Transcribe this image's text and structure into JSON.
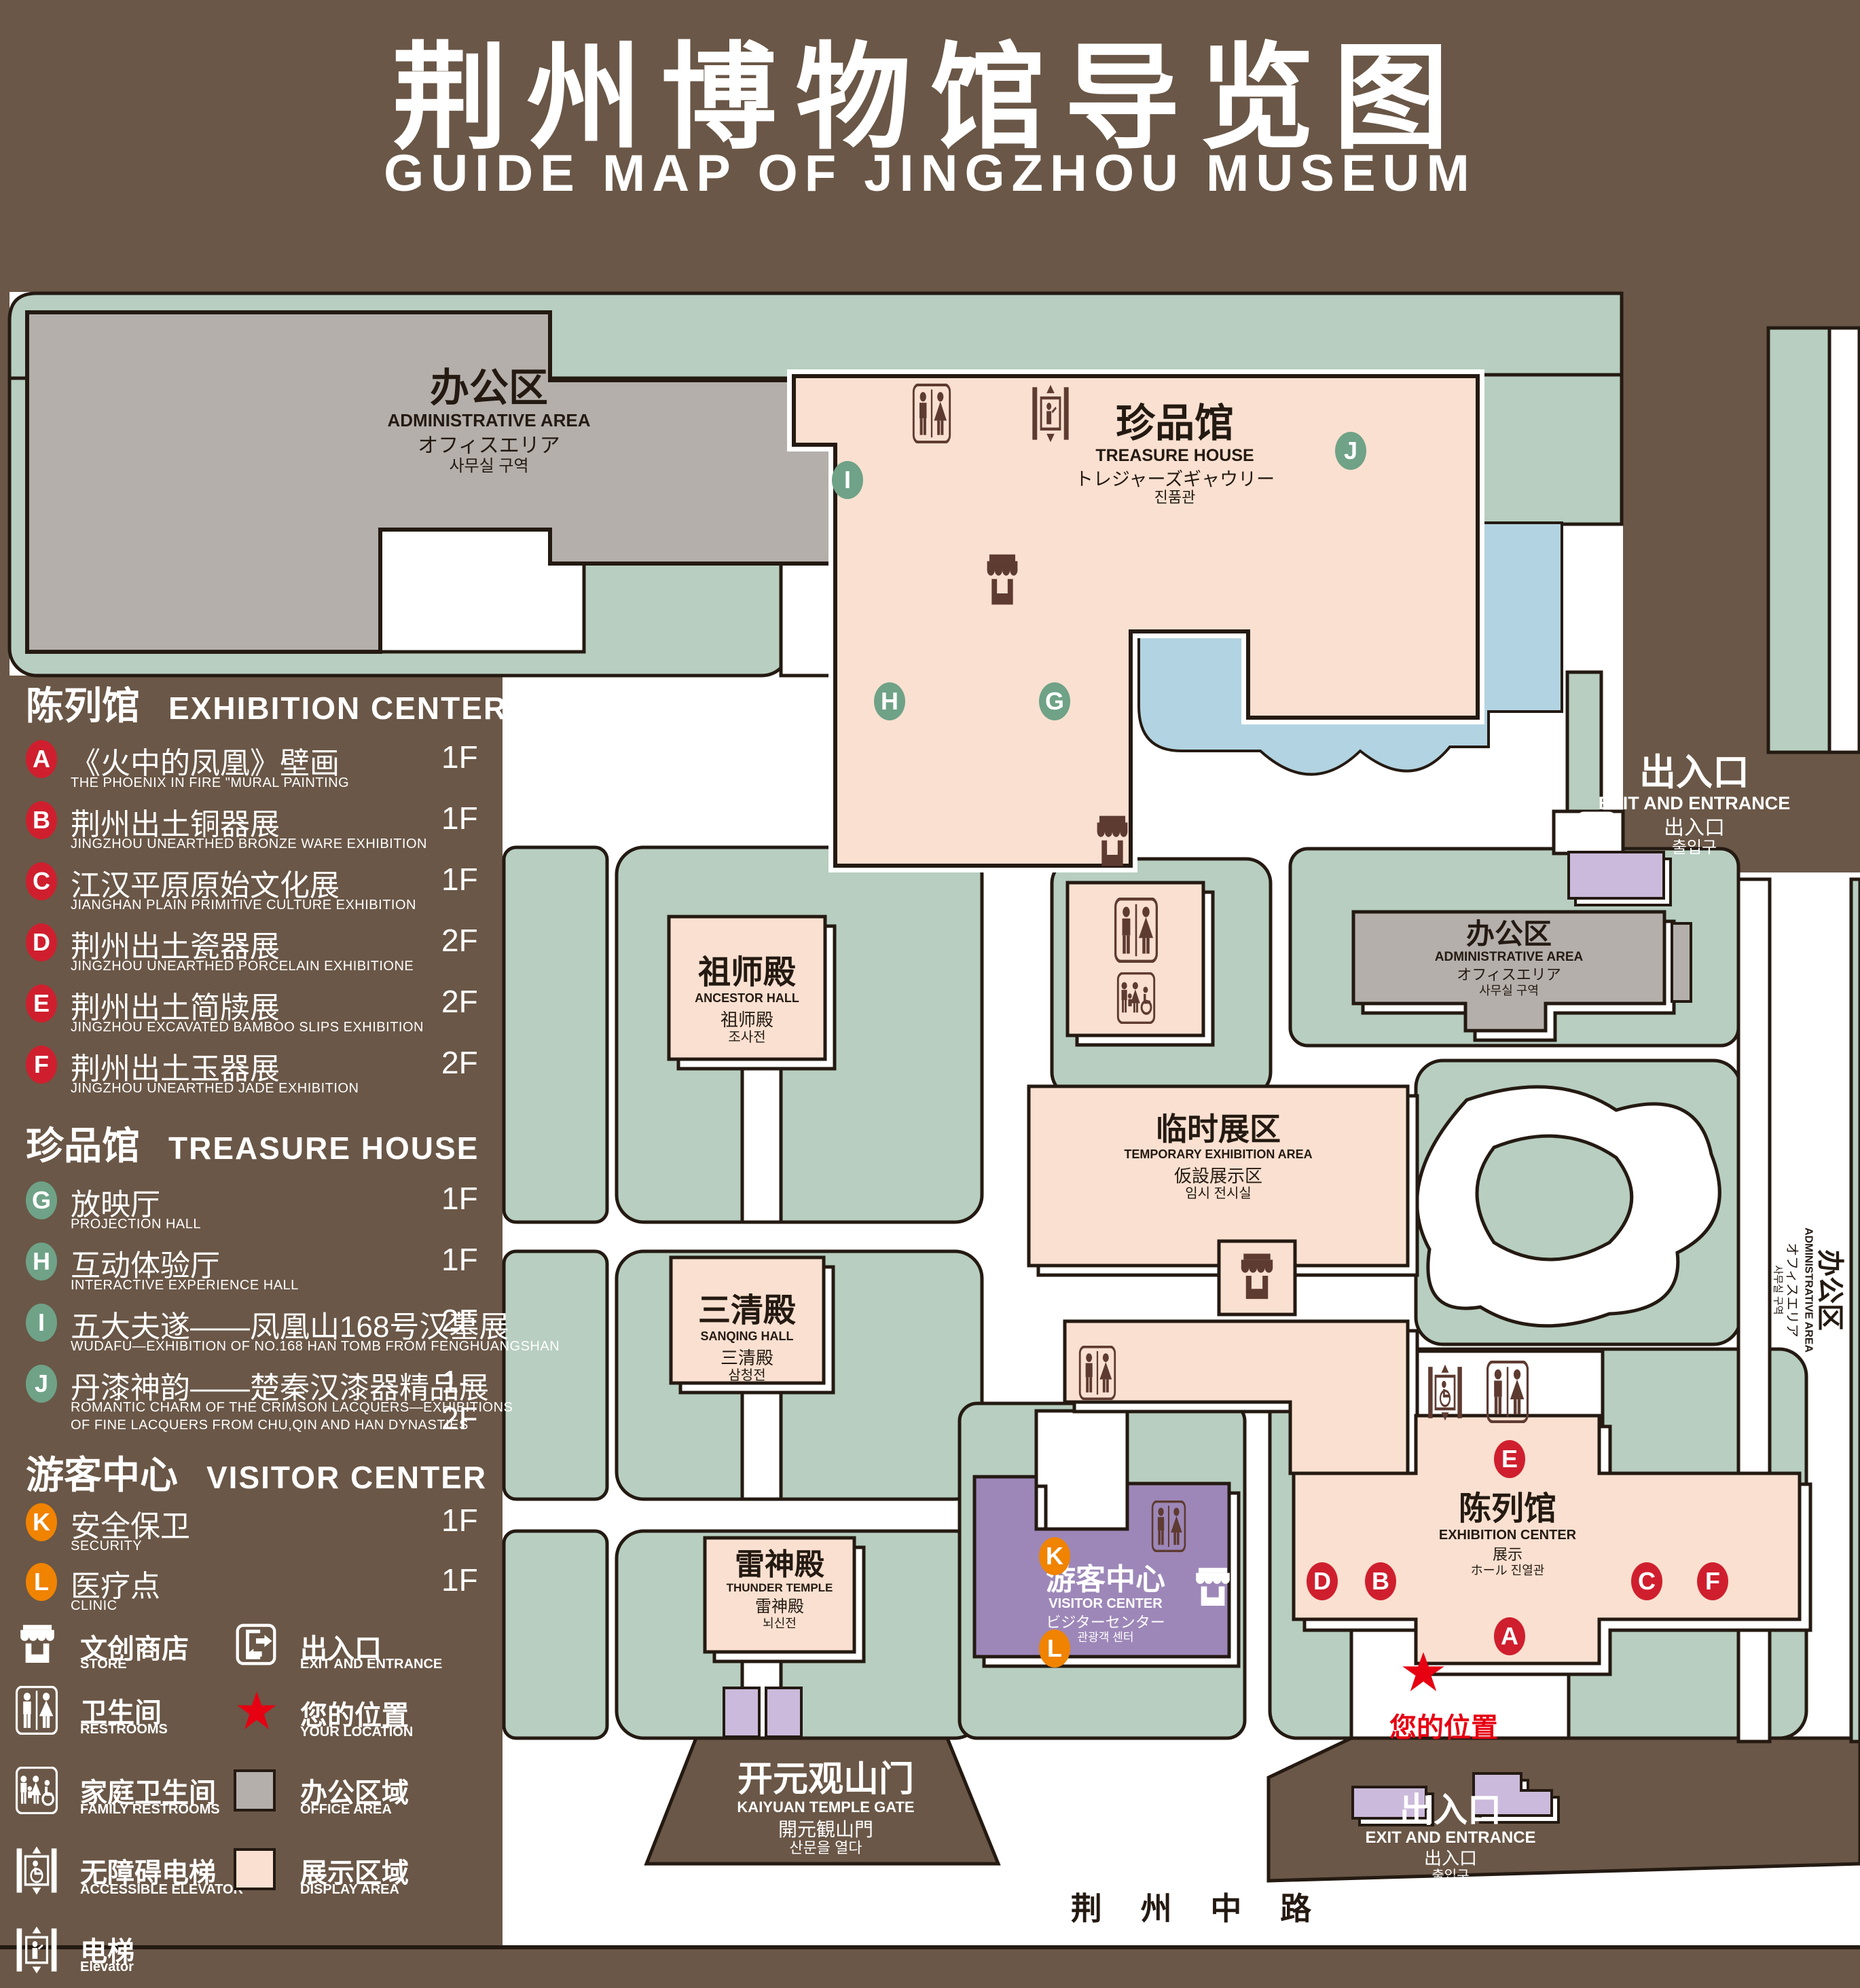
{
  "title": {
    "cn": "荆州博物馆导览图",
    "en": "GUIDE MAP OF JINGZHOU MUSEUM"
  },
  "legend": {
    "sections": [
      {
        "cn": "陈列馆",
        "en": "EXHIBITION CENTER",
        "items": [
          {
            "letter": "A",
            "cn": "《火中的凤凰》壁画",
            "en": "THE PHOENIX IN FIRE \"MURAL PAINTING",
            "floor": "1F"
          },
          {
            "letter": "B",
            "cn": "荆州出土铜器展",
            "en": "JINGZHOU UNEARTHED BRONZE WARE EXHIBITION",
            "floor": "1F"
          },
          {
            "letter": "C",
            "cn": "江汉平原原始文化展",
            "en": "JIANGHAN PLAIN PRIMITIVE CULTURE EXHIBITION",
            "floor": "1F"
          },
          {
            "letter": "D",
            "cn": "荆州出土瓷器展",
            "en": "JINGZHOU UNEARTHED PORCELAIN EXHIBITIONE",
            "floor": "2F"
          },
          {
            "letter": "E",
            "cn": "荆州出土简牍展",
            "en": "JINGZHOU EXCAVATED BAMBOO SLIPS EXHIBITION",
            "floor": "2F"
          },
          {
            "letter": "F",
            "cn": "荆州出土玉器展",
            "en": "JINGZHOU UNEARTHED JADE EXHIBITION",
            "floor": "2F"
          }
        ]
      },
      {
        "cn": "珍品馆",
        "en": "TREASURE HOUSE",
        "items": [
          {
            "letter": "G",
            "cn": "放映厅",
            "en": "PROJECTION HALL",
            "floor": "1F"
          },
          {
            "letter": "H",
            "cn": "互动体验厅",
            "en": "INTERACTIVE EXPERIENCE HALL",
            "floor": "1F"
          },
          {
            "letter": "I",
            "cn": "五大夫遂——凤凰山168号汉墓展",
            "en": "WUDAFU—EXHIBITION OF NO.168 HAN TOMB FROM FENGHUANGSHAN",
            "floor": "2F"
          },
          {
            "letter": "J",
            "cn": "丹漆神韵——楚秦汉漆器精品展",
            "en": "ROMANTIC CHARM OF THE CRIMSON LACQUERS—EXHIBITIONS",
            "en2": "OF FINE LACQUERS FROM CHU,QIN AND HAN DYNASTIES",
            "floor": "1-2F"
          }
        ]
      },
      {
        "cn": "游客中心",
        "en": "VISITOR CENTER",
        "items": [
          {
            "letter": "K",
            "cn": "安全保卫",
            "en": "SECURITY",
            "floor": "1F"
          },
          {
            "letter": "L",
            "cn": "医疗点",
            "en": "CLINIC",
            "floor": "1F"
          }
        ]
      }
    ],
    "icons": {
      "store": {
        "cn": "文创商店",
        "en": "STORE"
      },
      "restrooms": {
        "cn": "卫生间",
        "en": "RESTROOMS"
      },
      "family": {
        "cn": "家庭卫生间",
        "en": "FAMILY RESTROOMS"
      },
      "accessible": {
        "cn": "无障碍电梯",
        "en": "ACCESSIBLE  ELEVATOR"
      },
      "elevator": {
        "cn": "电梯",
        "en": "Elevator"
      },
      "exit": {
        "cn": "出入口",
        "en": "EXIT AND ENTRANCE"
      },
      "location": {
        "cn": "您的位置",
        "en": "YOUR LOCATION"
      },
      "office": {
        "cn": "办公区域",
        "en": "OFFICE AREA"
      },
      "display": {
        "cn": "展示区域",
        "en": "DISPLAY AREA"
      }
    }
  },
  "map": {
    "admin_tl": {
      "cn": "办公区",
      "en": "ADMINISTRATIVE AREA",
      "jp": "オフィスエリア",
      "kr": "사무실 구역"
    },
    "treasure": {
      "cn": "珍品馆",
      "en": "TREASURE HOUSE",
      "jp": "トレジャーズギャウリー",
      "kr": "진품관"
    },
    "exit_tr": {
      "cn": "出入口",
      "en": "EXIT AND ENTRANCE",
      "jp": "出入口",
      "kr": "출입구"
    },
    "ancestor": {
      "cn": "祖师殿",
      "en": "ANCESTOR HALL",
      "jp": "祖师殿",
      "kr": "조사전"
    },
    "temp": {
      "cn": "临时展区",
      "en": "TEMPORARY EXHIBITION AREA",
      "jp": "仮設展示区",
      "kr": "임시 전시실"
    },
    "admin_mr": {
      "cn": "办公区",
      "en": "ADMINISTRATIVE AREA",
      "jp": "オフィスエリア",
      "kr": "사무실 구역"
    },
    "admin_right": {
      "cn": "办公区",
      "en": "ADMINISTRATIVE AREA",
      "jp": "オフィスエリア",
      "kr": "사무실 구역"
    },
    "sanqing": {
      "cn": "三清殿",
      "en": "SANQING HALL",
      "jp": "三清殿",
      "kr": "삼청전"
    },
    "exhibition": {
      "cn": "陈列馆",
      "en": "EXHIBITION CENTER",
      "jp": "展示",
      "jp2": "ホール  진열관"
    },
    "thunder": {
      "cn": "雷神殿",
      "en": "THUNDER TEMPLE",
      "jp": "雷神殿",
      "kr": "뇌신전"
    },
    "visitor": {
      "cn": "游客中心",
      "en": "VISITOR CENTER",
      "jp": "ビジターセンター",
      "kr": "관광객 센터"
    },
    "gate": {
      "cn": "开元观山门",
      "en": "KAIYUAN TEMPLE GATE",
      "jp": "開元観山門",
      "kr": "산문을 열다"
    },
    "exit_b": {
      "cn": "出入口",
      "en": "EXIT AND ENTRANCE",
      "jp": "出入口",
      "kr": "출입구"
    },
    "road": "荆 州 中 路",
    "your_location": "您的位置",
    "markers": [
      {
        "letter": "A"
      },
      {
        "letter": "B"
      },
      {
        "letter": "C"
      },
      {
        "letter": "D"
      },
      {
        "letter": "E"
      },
      {
        "letter": "F"
      },
      {
        "letter": "G"
      },
      {
        "letter": "H"
      },
      {
        "letter": "I"
      },
      {
        "letter": "J"
      },
      {
        "letter": "K"
      },
      {
        "letter": "L"
      }
    ]
  },
  "colors": {
    "background": "#6a5747",
    "lawn_green": "#b7cec0",
    "display_area": "#fae0d0",
    "office_area": "#b4afab",
    "visitor_purple": "#9d87b8",
    "light_purple": "#cbbadb",
    "water_blue": "#b2d3e1",
    "icon_brown": "#5e3b31",
    "marker_red": "#cf1f2e",
    "marker_green": "#6fa287",
    "marker_orange": "#f08300",
    "star_red": "#e60012"
  }
}
